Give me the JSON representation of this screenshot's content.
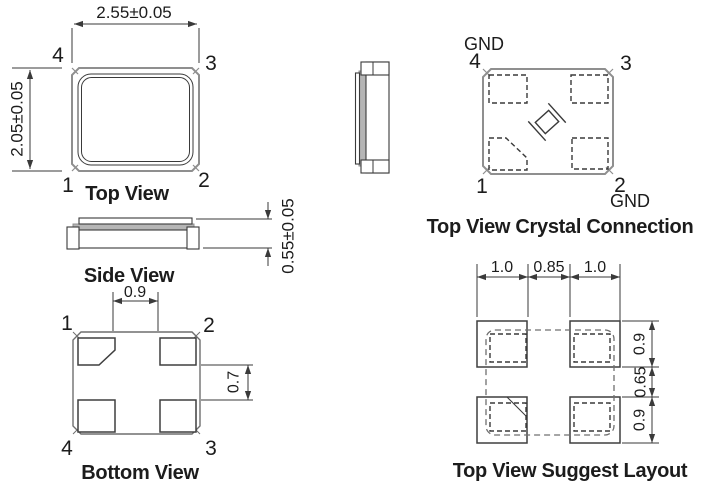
{
  "drawing_title": "Crystal Package Outline Drawing",
  "colors": {
    "line": "#3a3a3a",
    "body_outline": "#8f8f8f",
    "lid_fill": "#b5b5b5",
    "text": "#1c1c1c",
    "background": "#ffffff"
  },
  "views": {
    "top_view": {
      "caption": "Top View",
      "dim_width": "2.55±0.05",
      "dim_height": "2.05±0.05",
      "pins": {
        "tl": "4",
        "tr": "3",
        "bl": "1",
        "br": "2"
      }
    },
    "side_view": {
      "caption": "Side View",
      "dim_thickness": "0.55±0.05"
    },
    "bottom_view": {
      "caption": "Bottom View",
      "dim_pad_gap_x": "0.9",
      "dim_pad_gap_y": "0.7",
      "pins": {
        "tl": "1",
        "tr": "2",
        "bl": "4",
        "br": "3"
      }
    },
    "crystal_connection": {
      "caption": "Top View Crystal Connection",
      "gnd_top": "GND",
      "gnd_bottom": "GND",
      "pins": {
        "tl": "4",
        "tr": "3",
        "bl": "1",
        "br": "2"
      }
    },
    "suggest_layout": {
      "caption": "Top View Suggest Layout",
      "dims_top": [
        "1.0",
        "0.85",
        "1.0"
      ],
      "dims_right": [
        "0.9",
        "0.65",
        "0.9"
      ]
    }
  }
}
